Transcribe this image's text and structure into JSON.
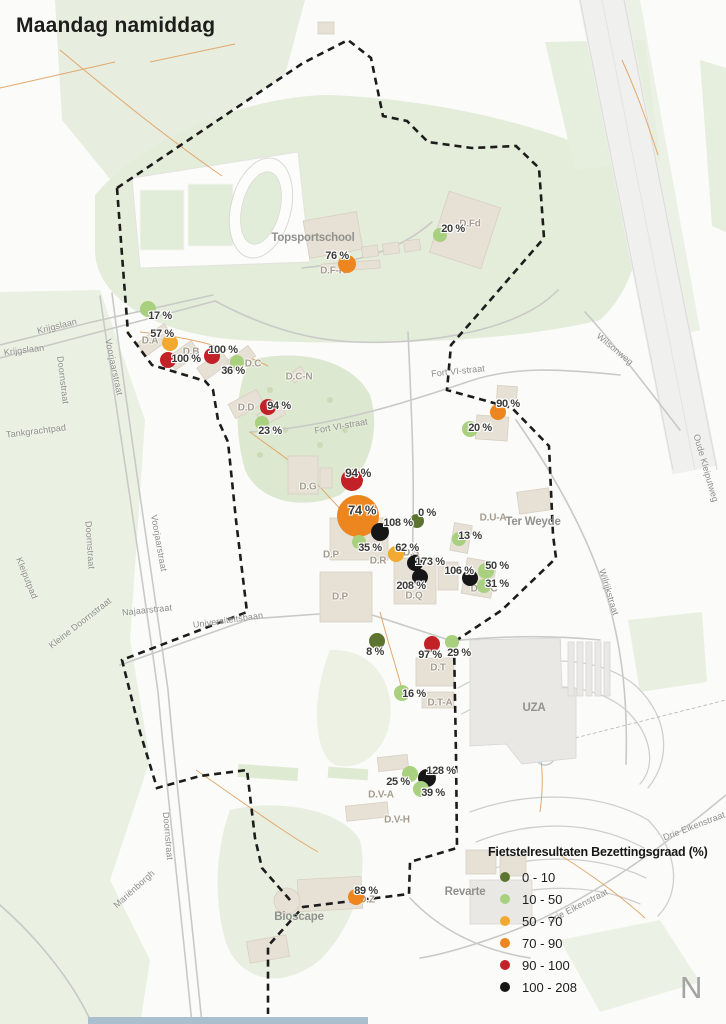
{
  "title": "Maandag namiddag",
  "north_label": "N",
  "legend": {
    "title": "Fietstelresultaten Bezettingsgraad (%)",
    "items": [
      {
        "label": "0 - 10",
        "band": "0-10"
      },
      {
        "label": "10 - 50",
        "band": "10-50"
      },
      {
        "label": "50 - 70",
        "band": "50-70"
      },
      {
        "label": "70 - 90",
        "band": "70-90"
      },
      {
        "label": "90 - 100",
        "band": "90-100"
      },
      {
        "label": "100 - 208",
        "band": "100-208"
      }
    ]
  },
  "band_colors": {
    "0-10": "#5d7431",
    "10-50": "#a8d07e",
    "50-70": "#f1a92f",
    "70-90": "#ee861f",
    "90-100": "#c22127",
    "100-208": "#161616"
  },
  "markers": [
    {
      "value": "20 %",
      "band": "10-50",
      "x": 440,
      "y": 235,
      "r": 7,
      "lx": 453,
      "ly": 229
    },
    {
      "value": "76 %",
      "band": "70-90",
      "x": 347,
      "y": 264,
      "r": 9,
      "lx": 337,
      "ly": 256
    },
    {
      "value": "17 %",
      "band": "10-50",
      "x": 148,
      "y": 309,
      "r": 8,
      "lx": 160,
      "ly": 316
    },
    {
      "value": "57 %",
      "band": "50-70",
      "x": 170,
      "y": 343,
      "r": 8,
      "lx": 162,
      "ly": 334
    },
    {
      "value": "100 %",
      "band": "90-100",
      "x": 168,
      "y": 360,
      "r": 8,
      "lx": 186,
      "ly": 359
    },
    {
      "value": "100 %",
      "band": "90-100",
      "x": 212,
      "y": 356,
      "r": 8,
      "lx": 223,
      "ly": 350
    },
    {
      "value": "36 %",
      "band": "10-50",
      "x": 237,
      "y": 362,
      "r": 7,
      "lx": 233,
      "ly": 371
    },
    {
      "value": "94 %",
      "band": "90-100",
      "x": 268,
      "y": 407,
      "r": 8,
      "lx": 279,
      "ly": 406
    },
    {
      "value": "23 %",
      "band": "10-50",
      "x": 262,
      "y": 423,
      "r": 7,
      "lx": 270,
      "ly": 431
    },
    {
      "value": "90 %",
      "band": "70-90",
      "x": 498,
      "y": 412,
      "r": 8,
      "lx": 508,
      "ly": 404
    },
    {
      "value": "20 %",
      "band": "10-50",
      "x": 470,
      "y": 429,
      "r": 8,
      "lx": 480,
      "ly": 428
    },
    {
      "value": "94 %",
      "band": "90-100",
      "x": 352,
      "y": 480,
      "r": 11,
      "lx": 358,
      "ly": 473,
      "fs": 12
    },
    {
      "value": "74 %",
      "band": "70-90",
      "x": 358,
      "y": 516,
      "r": 21,
      "lx": 362,
      "ly": 510,
      "fs": 13
    },
    {
      "value": "108 %",
      "band": "100-208",
      "x": 380,
      "y": 532,
      "r": 9,
      "lx": 398,
      "ly": 523
    },
    {
      "value": "0 %",
      "band": "0-10",
      "x": 417,
      "y": 521,
      "r": 7,
      "lx": 427,
      "ly": 513
    },
    {
      "value": "35 %",
      "band": "10-50",
      "x": 359,
      "y": 542,
      "r": 7,
      "lx": 370,
      "ly": 548
    },
    {
      "value": "13 %",
      "band": "10-50",
      "x": 459,
      "y": 539,
      "r": 7,
      "lx": 470,
      "ly": 536
    },
    {
      "value": "62 %",
      "band": "50-70",
      "x": 396,
      "y": 554,
      "r": 8,
      "lx": 407,
      "ly": 548
    },
    {
      "value": "173 %",
      "band": "100-208",
      "x": 415,
      "y": 563,
      "r": 8,
      "lx": 430,
      "ly": 562
    },
    {
      "value": "208 %",
      "band": "100-208",
      "x": 420,
      "y": 577,
      "r": 8,
      "lx": 411,
      "ly": 586
    },
    {
      "value": "106 %",
      "band": "100-208",
      "x": 470,
      "y": 578,
      "r": 8,
      "lx": 459,
      "ly": 571
    },
    {
      "value": "50 %",
      "band": "10-50",
      "x": 486,
      "y": 571,
      "r": 8,
      "lx": 497,
      "ly": 566
    },
    {
      "value": "31 %",
      "band": "10-50",
      "x": 484,
      "y": 586,
      "r": 7,
      "lx": 497,
      "ly": 584
    },
    {
      "value": "8 %",
      "band": "0-10",
      "x": 377,
      "y": 641,
      "r": 8,
      "lx": 375,
      "ly": 652
    },
    {
      "value": "97 %",
      "band": "90-100",
      "x": 432,
      "y": 644,
      "r": 8,
      "lx": 430,
      "ly": 655
    },
    {
      "value": "29 %",
      "band": "10-50",
      "x": 452,
      "y": 642,
      "r": 7,
      "lx": 459,
      "ly": 653
    },
    {
      "value": "16 %",
      "band": "10-50",
      "x": 402,
      "y": 693,
      "r": 8,
      "lx": 414,
      "ly": 694
    },
    {
      "value": "25 %",
      "band": "10-50",
      "x": 410,
      "y": 774,
      "r": 8,
      "lx": 398,
      "ly": 782
    },
    {
      "value": "128 %",
      "band": "100-208",
      "x": 427,
      "y": 778,
      "r": 9,
      "lx": 441,
      "ly": 771
    },
    {
      "value": "39 %",
      "band": "10-50",
      "x": 421,
      "y": 789,
      "r": 8,
      "lx": 433,
      "ly": 793
    },
    {
      "value": "89 %",
      "band": "70-90",
      "x": 356,
      "y": 897,
      "r": 8,
      "lx": 366,
      "ly": 891
    }
  ],
  "building_labels": [
    {
      "t": "D.Fd",
      "x": 470,
      "y": 224
    },
    {
      "t": "D.F-K",
      "x": 333,
      "y": 271
    },
    {
      "t": "D.A",
      "x": 150,
      "y": 341
    },
    {
      "t": "D.B",
      "x": 191,
      "y": 352
    },
    {
      "t": "D.C",
      "x": 253,
      "y": 364
    },
    {
      "t": "D.C-N",
      "x": 299,
      "y": 377
    },
    {
      "t": "D.D",
      "x": 246,
      "y": 408
    },
    {
      "t": "D.G",
      "x": 308,
      "y": 487
    },
    {
      "t": "D.P",
      "x": 331,
      "y": 555
    },
    {
      "t": "D.R",
      "x": 378,
      "y": 561
    },
    {
      "t": "D.S",
      "x": 411,
      "y": 553
    },
    {
      "t": "D.P",
      "x": 340,
      "y": 597
    },
    {
      "t": "D.Q",
      "x": 414,
      "y": 596
    },
    {
      "t": "D.U-A",
      "x": 493,
      "y": 518
    },
    {
      "t": "D.U-C",
      "x": 484,
      "y": 589
    },
    {
      "t": "D.T",
      "x": 438,
      "y": 668
    },
    {
      "t": "D.T-A",
      "x": 440,
      "y": 703
    },
    {
      "t": "D.V-A",
      "x": 381,
      "y": 795
    },
    {
      "t": "D.V-H",
      "x": 397,
      "y": 820
    },
    {
      "t": "D.Z",
      "x": 367,
      "y": 900
    }
  ],
  "area_labels": [
    {
      "t": "Topsportschool",
      "x": 313,
      "y": 238
    },
    {
      "t": "Ter Weyde",
      "x": 533,
      "y": 522
    },
    {
      "t": "UZA",
      "x": 534,
      "y": 708
    },
    {
      "t": "Bioscape",
      "x": 299,
      "y": 917
    },
    {
      "t": "Revarte",
      "x": 465,
      "y": 892
    }
  ],
  "street_labels": [
    {
      "t": "Krijgslaan",
      "x": 57,
      "y": 326,
      "r": -14
    },
    {
      "t": "Krijgslaan",
      "x": 24,
      "y": 350,
      "r": -7
    },
    {
      "t": "Doornstraat",
      "x": 63,
      "y": 380,
      "r": 83
    },
    {
      "t": "Voorjaarstraat",
      "x": 114,
      "y": 367,
      "r": 78
    },
    {
      "t": "Tankgrachtpad",
      "x": 36,
      "y": 431,
      "r": -7
    },
    {
      "t": "Doornstraat",
      "x": 90,
      "y": 545,
      "r": 86
    },
    {
      "t": "Voorjaarstraat",
      "x": 159,
      "y": 543,
      "r": 80
    },
    {
      "t": "Kleiputpad",
      "x": 27,
      "y": 578,
      "r": 68
    },
    {
      "t": "Kleine Doornstraat",
      "x": 80,
      "y": 623,
      "r": -38
    },
    {
      "t": "Najaarstraat",
      "x": 147,
      "y": 610,
      "r": -6
    },
    {
      "t": "Universiteitsbaan",
      "x": 228,
      "y": 620,
      "r": -8
    },
    {
      "t": "Fort VI-straat",
      "x": 458,
      "y": 371,
      "r": -6
    },
    {
      "t": "Fort VI-straat",
      "x": 341,
      "y": 426,
      "r": -10
    },
    {
      "t": "Wilsonweg",
      "x": 615,
      "y": 349,
      "r": 40
    },
    {
      "t": "Oude Kleiputweg",
      "x": 706,
      "y": 468,
      "r": 74
    },
    {
      "t": "Wilrijkstraat",
      "x": 609,
      "y": 592,
      "r": 73
    },
    {
      "t": "Drie Eikenstraat",
      "x": 694,
      "y": 826,
      "r": -21
    },
    {
      "t": "Drie Eikenstraat",
      "x": 578,
      "y": 906,
      "r": -27
    },
    {
      "t": "Mariënborgh",
      "x": 134,
      "y": 889,
      "r": -42
    },
    {
      "t": "Doornstraat",
      "x": 168,
      "y": 836,
      "r": 85
    }
  ]
}
